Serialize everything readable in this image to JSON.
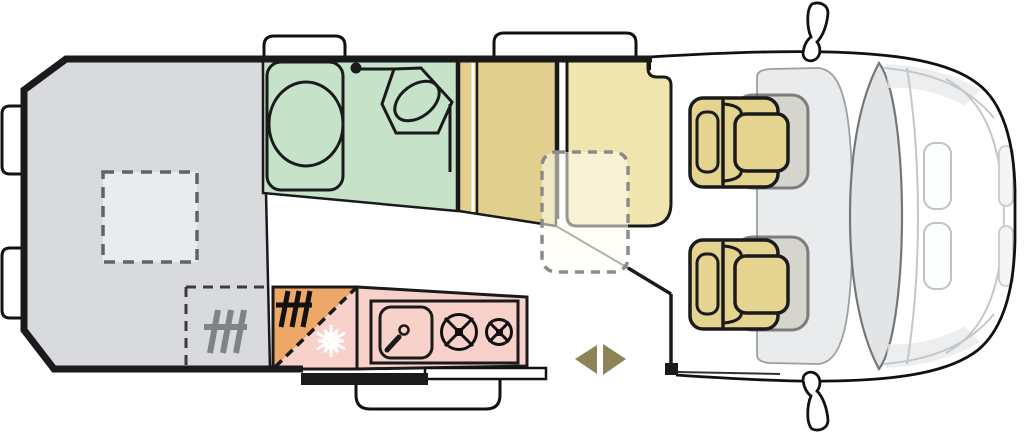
{
  "meta": {
    "type": "campervan-floorplan",
    "description": "Top-down floor plan of a camper van: rear bed, bathroom, wardrobe, bench seat with table, kitchen block, swivel cab seats"
  },
  "colors": {
    "outline": "#1a1a1a",
    "bed": "#d8dadd",
    "skylight": "#eaebed",
    "bathroom": "#c6e3c9",
    "wardrobe": "#e0cf8d",
    "bench": "#f0e4af",
    "table_fill": "rgba(255,253,244,0.55)",
    "table_stroke": "#8b8b87",
    "seat": "#e5d390",
    "seat_ghost_fill": "rgba(175,168,140,0.32)",
    "seat_ghost_stroke": "rgba(70,70,70,0.65)",
    "heater_block": "#eda766",
    "fridge_block": "#f8d2ca",
    "kitchen_counter": "#f8d2ca",
    "heater_icon_gray": "#7f8386",
    "arrow": "#8d8258",
    "cab_dash": "#e9ebec",
    "windshield": "#e2e4e6",
    "hood_line": "#c4c7ca",
    "white": "#ffffff"
  },
  "icons": [
    "toilet-icon",
    "washbasin-icon",
    "shower-cubicle-icon",
    "heater-icon",
    "fridge-snowflake-icon",
    "sink-icon",
    "burner-large-icon",
    "burner-small-icon",
    "skylight-icon",
    "table-outline-icon",
    "bed-extension-icon",
    "entry-step-icon",
    "sliding-door-icon",
    "window-icon",
    "mirror-icon",
    "swivel-seat-icon",
    "arrow-left-icon",
    "arrow-right-icon"
  ],
  "regions": [
    {
      "name": "rear-bed",
      "color_key": "bed"
    },
    {
      "name": "bathroom",
      "color_key": "bathroom"
    },
    {
      "name": "wardrobe",
      "color_key": "wardrobe"
    },
    {
      "name": "bench-seat",
      "color_key": "bench"
    },
    {
      "name": "kitchen-heater-corner",
      "color_key": "heater_block"
    },
    {
      "name": "kitchen-fridge-corner",
      "color_key": "fridge_block"
    },
    {
      "name": "kitchen-counter",
      "color_key": "kitchen_counter"
    },
    {
      "name": "cab-seats",
      "color_key": "seat"
    }
  ]
}
